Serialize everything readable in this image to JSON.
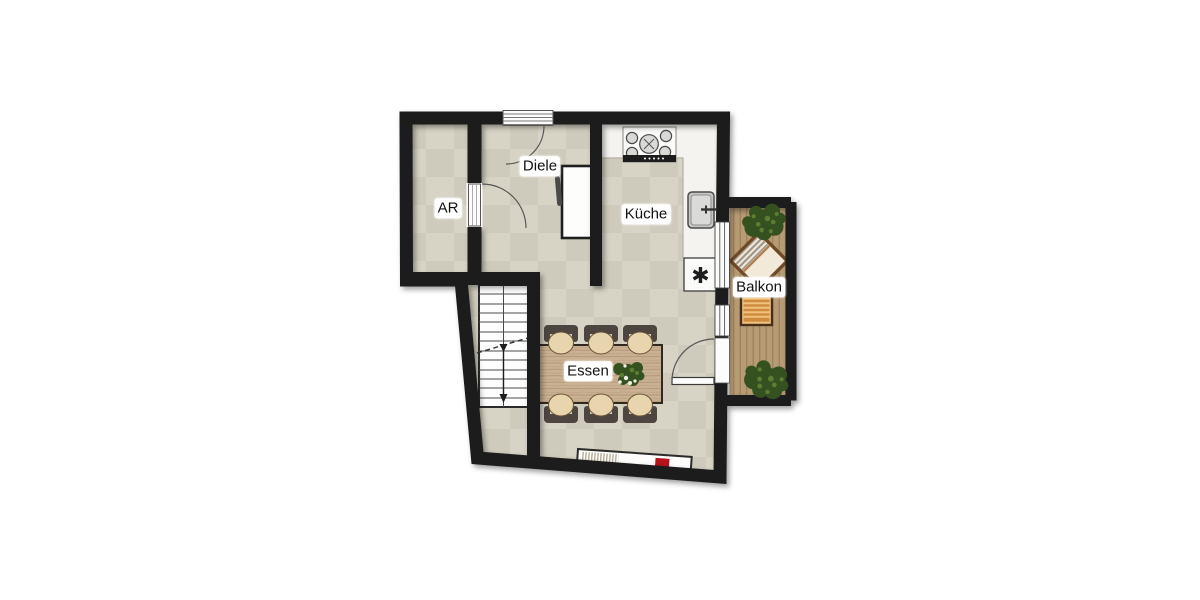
{
  "plan": {
    "rooms": [
      {
        "id": "ar",
        "label": "AR"
      },
      {
        "id": "diele",
        "label": "Diele"
      },
      {
        "id": "kueche",
        "label": "Küche"
      },
      {
        "id": "essen",
        "label": "Essen"
      },
      {
        "id": "balkon",
        "label": "Balkon"
      }
    ],
    "symbols": {
      "dishwasher_asterisk": "✱"
    },
    "colors": {
      "wall": "#1a1a1a",
      "floor": "#d7d3c5",
      "floor_patch": "#ccc8b9",
      "counter": "#f4f3ef",
      "stair": "#fdfdfd",
      "deck": "#b79b74",
      "deck_line": "#9a7f58",
      "table_wood": "#cbb193",
      "table_grain": "#aa9070",
      "chair_seat": "#e9d5ad",
      "chair_frame": "#4c4540",
      "plant_dark": "#35511f",
      "plant_light": "#5d7d33",
      "bench": "#f0c27d",
      "bench_slat": "#d08c3e",
      "lounge": "#f3e9d8",
      "lounge_border": "#6e4a28",
      "accent_red": "#b5121b"
    }
  }
}
